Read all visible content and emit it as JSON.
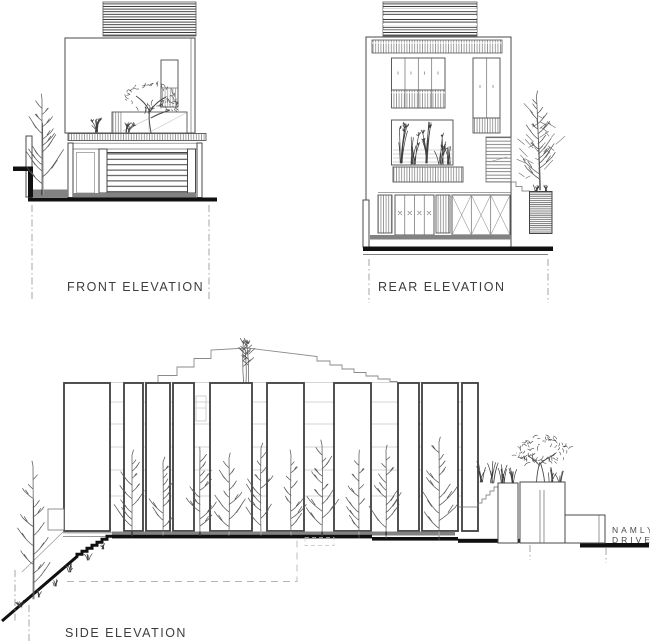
{
  "colors": {
    "ink": "#3d3d3d",
    "ink_strong": "#101010",
    "line_light": "#9b9b9b",
    "background": "#ffffff"
  },
  "labels": {
    "front": "FRONT ELEVATION",
    "rear": "REAR ELEVATION",
    "side": "SIDE ELEVATION"
  },
  "street": {
    "name_line1": "NAMLY",
    "name_line2": "DRIVE"
  }
}
